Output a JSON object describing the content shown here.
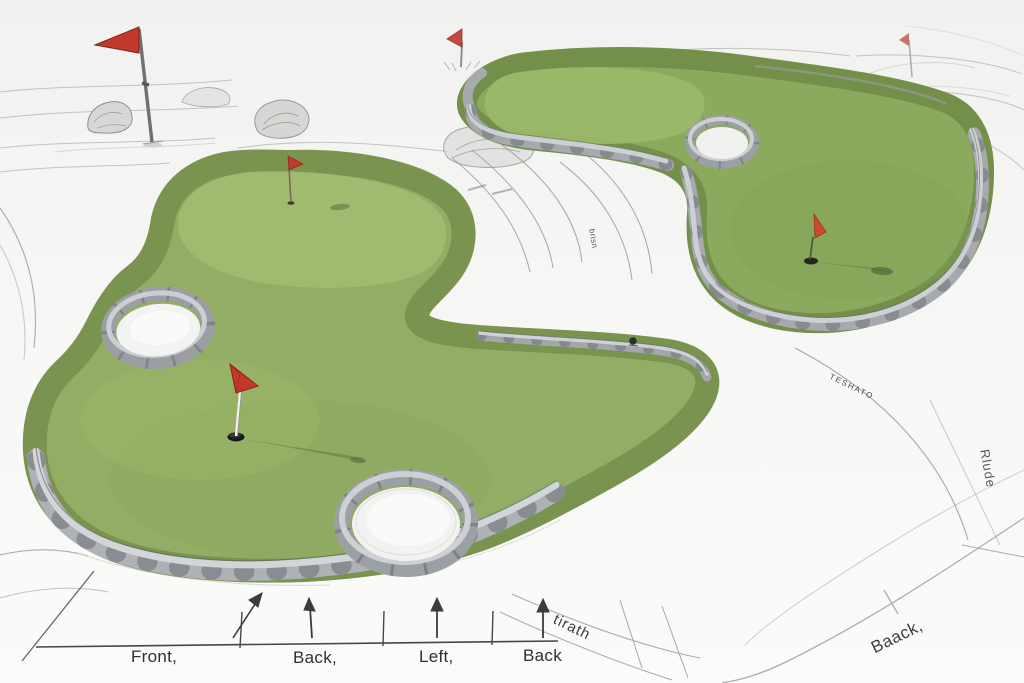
{
  "axis_labels": [
    "Front,",
    "Back,",
    "Left,",
    "Back"
  ],
  "curve_labels": {
    "tirath": "tirath",
    "baack": "Baack,",
    "rlude": "Rlude",
    "teshato": "TESHATO",
    "brisn": "brisn"
  },
  "icons": {
    "flags": [
      "tall-flag-icon",
      "small-flag-icon",
      "faint-flag-icon",
      "upper-green-flagstick-icon",
      "left-green-flagstick-icon",
      "right-green-flagstick-icon"
    ]
  },
  "colors": {
    "left_green": "#93ae64",
    "left_green_light": "#a2bd71",
    "left_green_rim": "#7a9450",
    "right_green": "#8caa5e",
    "right_green_light": "#9cb96c",
    "right_green_rim": "#748f4a",
    "flag_red": "#c2392b",
    "stone_face": "#a4a8ad",
    "stone_top": "#cfd3d7",
    "sand": "#f6f6f4",
    "sketch_line": "#9a9a98",
    "annotation_ink": "#3b3b3b"
  }
}
